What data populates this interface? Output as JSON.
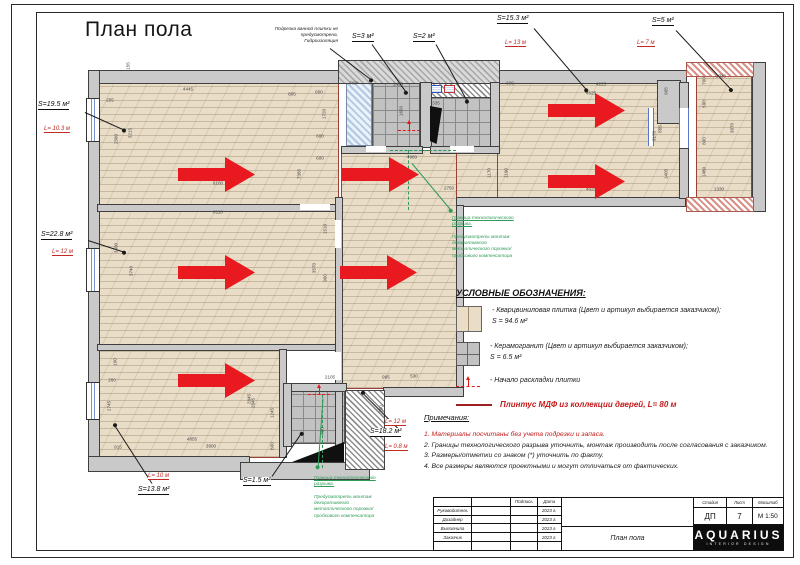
{
  "sheet": {
    "title": "План пола"
  },
  "colors": {
    "arrow_red": "#e8191f",
    "plinth_red": "#9c3f35",
    "green": "#2e9b57",
    "floor_beige": "#e9ddc7",
    "tile_gray": "#c2c2c2"
  },
  "plan": {
    "bath_note": "Подрезка ванной плитки не\nпредусмотрена.\nГидроизоляция",
    "area_labels": [
      {
        "text": "S=19.5 м²",
        "x": 38,
        "y": 101
      },
      {
        "text": "S=3 м²",
        "x": 352,
        "y": 33
      },
      {
        "text": "S=2 м²",
        "x": 413,
        "y": 33
      },
      {
        "text": "S=15.3 м²",
        "x": 497,
        "y": 15
      },
      {
        "text": "S=5 м²",
        "x": 652,
        "y": 17
      },
      {
        "text": "S=22.8 м²",
        "x": 41,
        "y": 231
      },
      {
        "text": "S=18.2 м²",
        "x": 370,
        "y": 428
      },
      {
        "text": "S=1.5 м²",
        "x": 243,
        "y": 477
      },
      {
        "text": "S=13.8 м²",
        "x": 138,
        "y": 486
      }
    ],
    "length_labels": [
      {
        "text": "L= 10.3 м",
        "x": 44,
        "y": 126
      },
      {
        "text": "L= 13 м",
        "x": 505,
        "y": 40
      },
      {
        "text": "L= 7 м",
        "x": 637,
        "y": 40
      },
      {
        "text": "L= 12 м",
        "x": 52,
        "y": 249
      },
      {
        "text": "L= 12 м",
        "x": 385,
        "y": 419
      },
      {
        "text": "L= 0.8 м",
        "x": 385,
        "y": 444
      },
      {
        "text": "L= 10 м",
        "x": 148,
        "y": 473
      }
    ],
    "green_notes": [
      {
        "x": 452,
        "y": 210,
        "head": "Граница технологического\nразрыва.",
        "body": "Предусмотреть монтаж\nдекоративного\nметаллического порожка/\nпробкового компенсатора"
      },
      {
        "x": 314,
        "y": 470,
        "head": "Граница технологического\nразрыва.",
        "body": "Предусмотреть монтаж\nдекоративного\nметаллического порожка/\nпробкового компенсатора"
      }
    ],
    "arrows": [
      {
        "x": 178,
        "y": 156
      },
      {
        "x": 342,
        "y": 156
      },
      {
        "x": 548,
        "y": 92
      },
      {
        "x": 548,
        "y": 163
      },
      {
        "x": 178,
        "y": 254
      },
      {
        "x": 340,
        "y": 254
      },
      {
        "x": 178,
        "y": 362
      }
    ],
    "start_marks": [
      {
        "x": 398,
        "y": 122
      },
      {
        "x": 308,
        "y": 386
      }
    ],
    "leaders": [
      {
        "x1": 85,
        "y1": 112,
        "x2": 125,
        "y2": 130
      },
      {
        "x1": 88,
        "y1": 240,
        "x2": 125,
        "y2": 252
      },
      {
        "x1": 152,
        "y1": 483,
        "x2": 114,
        "y2": 424
      },
      {
        "x1": 272,
        "y1": 476,
        "x2": 302,
        "y2": 432
      },
      {
        "x1": 398,
        "y1": 428,
        "x2": 362,
        "y2": 392
      },
      {
        "x1": 372,
        "y1": 44,
        "x2": 407,
        "y2": 93
      },
      {
        "x1": 436,
        "y1": 44,
        "x2": 468,
        "y2": 102
      },
      {
        "x1": 534,
        "y1": 28,
        "x2": 587,
        "y2": 90
      },
      {
        "x1": 676,
        "y1": 30,
        "x2": 732,
        "y2": 90
      },
      {
        "x1": 330,
        "y1": 48,
        "x2": 372,
        "y2": 80
      },
      {
        "x1": 412,
        "y1": 163,
        "x2": 452,
        "y2": 211,
        "c": "#2e9b57"
      },
      {
        "x1": 323,
        "y1": 398,
        "x2": 318,
        "y2": 468,
        "c": "#2e9b57"
      }
    ],
    "dimensions": [
      {
        "t": "4445",
        "x": 188,
        "y": 89
      },
      {
        "t": "805",
        "x": 292,
        "y": 94
      },
      {
        "t": "600",
        "x": 319,
        "y": 92
      },
      {
        "t": "255",
        "x": 110,
        "y": 100
      },
      {
        "t": "155",
        "x": 128,
        "y": 66,
        "r": 1
      },
      {
        "t": "2580",
        "x": 116,
        "y": 139,
        "r": 1
      },
      {
        "t": "3215",
        "x": 130,
        "y": 133,
        "r": 1
      },
      {
        "t": "1720",
        "x": 324,
        "y": 114,
        "r": 1
      },
      {
        "t": "600",
        "x": 320,
        "y": 136
      },
      {
        "t": "600",
        "x": 320,
        "y": 158
      },
      {
        "t": "6180",
        "x": 218,
        "y": 183
      },
      {
        "t": "7385",
        "x": 299,
        "y": 174,
        "r": 1
      },
      {
        "t": "6110",
        "x": 218,
        "y": 212
      },
      {
        "t": "1510",
        "x": 325,
        "y": 229,
        "r": 1
      },
      {
        "t": "3490",
        "x": 116,
        "y": 248,
        "r": 1
      },
      {
        "t": "3740",
        "x": 131,
        "y": 271,
        "r": 1
      },
      {
        "t": "3570",
        "x": 314,
        "y": 268,
        "r": 1
      },
      {
        "t": "900",
        "x": 325,
        "y": 278,
        "r": 1
      },
      {
        "t": "760*",
        "x": 354,
        "y": 83
      },
      {
        "t": "1425",
        "x": 398,
        "y": 84
      },
      {
        "t": "1650",
        "x": 401,
        "y": 111,
        "r": 1
      },
      {
        "t": "335",
        "x": 436,
        "y": 103
      },
      {
        "t": "4980",
        "x": 412,
        "y": 157
      },
      {
        "t": "2750",
        "x": 449,
        "y": 188
      },
      {
        "t": "1170",
        "x": 489,
        "y": 173,
        "r": 1
      },
      {
        "t": "1190",
        "x": 506,
        "y": 173,
        "r": 1
      },
      {
        "t": "600",
        "x": 510,
        "y": 83
      },
      {
        "t": "4225",
        "x": 601,
        "y": 84
      },
      {
        "t": "4625",
        "x": 591,
        "y": 93
      },
      {
        "t": "905",
        "x": 666,
        "y": 91,
        "r": 1
      },
      {
        "t": "855",
        "x": 660,
        "y": 129,
        "r": 1
      },
      {
        "t": "3170",
        "x": 654,
        "y": 136,
        "r": 1
      },
      {
        "t": "1405",
        "x": 666,
        "y": 174,
        "r": 1
      },
      {
        "t": "4625",
        "x": 591,
        "y": 189
      },
      {
        "t": "700",
        "x": 704,
        "y": 81,
        "r": 1
      },
      {
        "t": "590",
        "x": 704,
        "y": 104,
        "r": 1
      },
      {
        "t": "800",
        "x": 704,
        "y": 141,
        "r": 1
      },
      {
        "t": "1480",
        "x": 704,
        "y": 172,
        "r": 1
      },
      {
        "t": "1330",
        "x": 721,
        "y": 76
      },
      {
        "t": "3870",
        "x": 732,
        "y": 128,
        "r": 1
      },
      {
        "t": "1330",
        "x": 719,
        "y": 189
      },
      {
        "t": "2105",
        "x": 330,
        "y": 377
      },
      {
        "t": "995",
        "x": 386,
        "y": 377
      },
      {
        "t": "530",
        "x": 414,
        "y": 376
      },
      {
        "t": "2845",
        "x": 253,
        "y": 403,
        "r": 1
      },
      {
        "t": "1245",
        "x": 272,
        "y": 413,
        "r": 1
      },
      {
        "t": "600",
        "x": 272,
        "y": 446,
        "r": 1
      },
      {
        "t": "400",
        "x": 322,
        "y": 431,
        "r": 1
      },
      {
        "t": "200",
        "x": 381,
        "y": 409,
        "r": 1
      },
      {
        "t": "100",
        "x": 115,
        "y": 362,
        "r": 1
      },
      {
        "t": "260",
        "x": 112,
        "y": 380
      },
      {
        "t": "2745",
        "x": 109,
        "y": 406,
        "r": 1
      },
      {
        "t": "2845",
        "x": 249,
        "y": 399,
        "r": 1
      },
      {
        "t": "4855",
        "x": 192,
        "y": 439
      },
      {
        "t": "3900",
        "x": 211,
        "y": 446
      },
      {
        "t": "915",
        "x": 118,
        "y": 447
      }
    ]
  },
  "legend": {
    "header": "УСЛОВНЫЕ ОБОЗНАЧЕНИЯ:",
    "quartz_line1": "- Кварцвиниловая плитка (Цвет и артикул выбирается заказчиком);",
    "quartz_line2": "S = 94.6 м²",
    "ceramic_line1": "- Керамогранит (Цвет и артикул выбирается заказчиком);",
    "ceramic_line2": "S = 6.5 м²",
    "start_label": "- Начало раскладки плитки",
    "plinth_label": "Плинтус МДФ из коллекции дверей, L= 80 м"
  },
  "notes": {
    "header": "Примечания:",
    "items": [
      {
        "text": "1. Материалы посчитаны без учета подрезки и запаса.",
        "red": 1
      },
      {
        "text": "2. Границы технологического разрыва уточнить, монтаж производить после согласования с заказчиком."
      },
      {
        "text": "3. Размеры/отметки  со знаком (*) уточнить по факту."
      },
      {
        "text": "4. Все размеры являются проектными и могут отличаться от фактических."
      }
    ]
  },
  "title_block": {
    "rows": [
      {
        "c1": "",
        "c2": "",
        "c3": "Подпись",
        "c4": "Дата"
      },
      {
        "c1": "Руководитель",
        "c2": "",
        "c3": "",
        "c4": "2023 г."
      },
      {
        "c1": "Дизайнер",
        "c2": "",
        "c3": "",
        "c4": "2023 г."
      },
      {
        "c1": "Выполнила",
        "c2": "",
        "c3": "",
        "c4": "2023 г."
      },
      {
        "c1": "Заказчик",
        "c2": "",
        "c3": "",
        "c4": "2023 г."
      },
      {
        "c1": "",
        "c2": "",
        "c3": "",
        "c4": ""
      }
    ],
    "project": "План пола",
    "stage_h": "Стадия",
    "sheet_h": "Лист",
    "scale_h": "Масштаб",
    "stage": "ДП",
    "sheet": "7",
    "scale": "М 1:50",
    "logo": "AQUARIUS",
    "logo_sub": "INTERIOR DESIGN"
  }
}
